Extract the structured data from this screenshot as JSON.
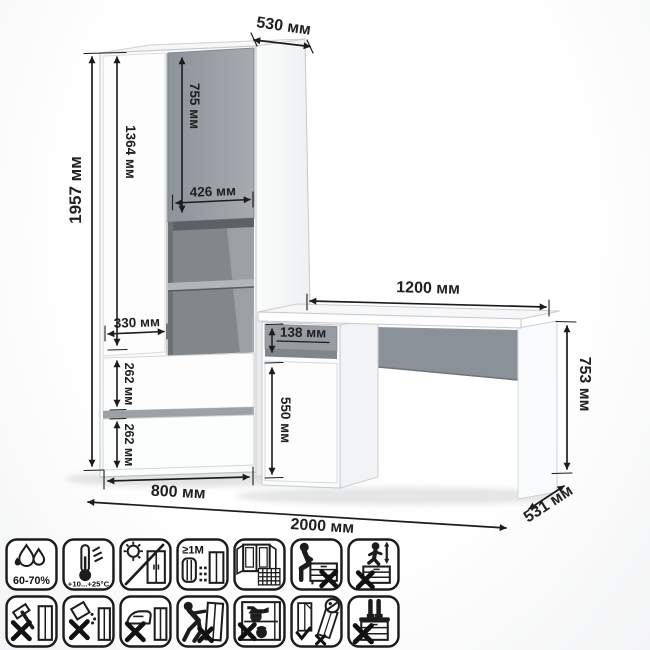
{
  "drawing_title": "furniture-dimension-diagram",
  "colors": {
    "dim_text": "#1f1f1f",
    "gray_panel": "#9aa0a6",
    "gray_dark_interior": "#7b8085",
    "white_panel": "#fcfcfd",
    "outline": "#c7cacd",
    "icon_stroke": "#1c1c1c"
  },
  "dimensions": {
    "d530": "530 мм",
    "d1957": "1957 мм",
    "d1364": "1364 мм",
    "d755": "755 мм",
    "d426": "426 мм",
    "d330": "330 мм",
    "d262a": "262 мм",
    "d262b": "262 мм",
    "d800": "800 мм",
    "d138": "138 мм",
    "d550": "550 мм",
    "d1200": "1200 мм",
    "d753": "753 мм",
    "d531": "531 мм",
    "d2000": "2000 мм"
  },
  "icons": {
    "row1": [
      {
        "name": "humidity-icon",
        "label": "60-70%"
      },
      {
        "name": "temperature-icon",
        "label": "+10...+25°C"
      },
      {
        "name": "no-direct-sunlight-icon",
        "label": ""
      },
      {
        "name": "heat-source-distance-icon",
        "label": "≥1M"
      },
      {
        "name": "ventilation-icon",
        "label": ""
      },
      {
        "name": "no-sitting-icon",
        "label": ""
      },
      {
        "name": "no-jumping-icon",
        "label": ""
      }
    ],
    "row2": [
      {
        "name": "no-impact-icon",
        "label": ""
      },
      {
        "name": "no-spilling-icon",
        "label": ""
      },
      {
        "name": "no-hot-objects-icon",
        "label": ""
      },
      {
        "name": "no-dragging-icon",
        "label": ""
      },
      {
        "name": "no-overloading-icon",
        "label": ""
      },
      {
        "name": "anti-tip-anchor-icon",
        "label": ""
      },
      {
        "name": "no-standing-icon",
        "label": ""
      }
    ]
  }
}
